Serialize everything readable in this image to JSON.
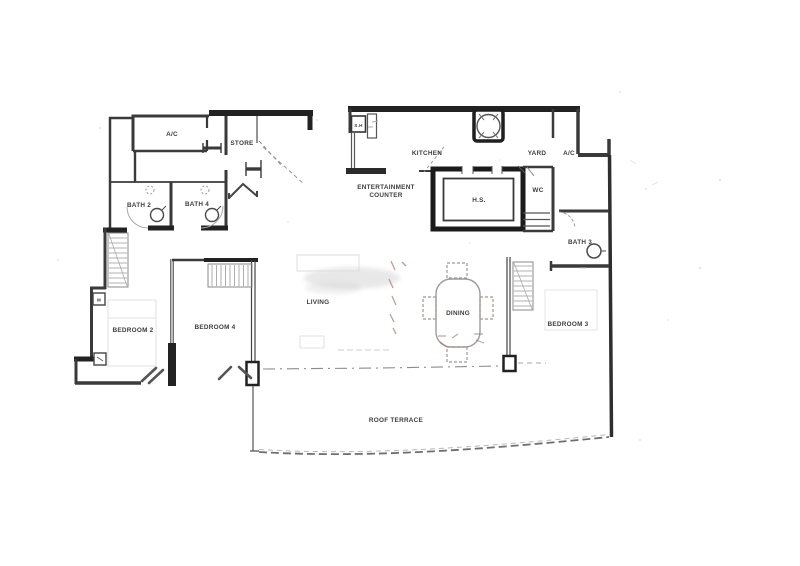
{
  "title": "apartment-floor-plan",
  "colors": {
    "background": "#ffffff",
    "wall_dark": "#222222",
    "wall_mid": "#3a3a3a",
    "wall_light": "#888888",
    "label_text": "#3d3d3d",
    "terrace_dash": "#6f6f6f",
    "furniture_red_accent": "#a5685c",
    "watermark_grey": "#c8c8c8"
  },
  "labels": {
    "ac_left": "A/C",
    "store": "STORE",
    "sh": "S.H",
    "kitchen": "KITCHEN",
    "yard": "YARD",
    "ac_right": "A/C",
    "entertainment_line1": "ENTERTAINMENT",
    "entertainment_line2": "COUNTER",
    "hs": "H.S.",
    "wc": "WC",
    "bath2": "BATH 2",
    "bath4": "BATH 4",
    "bath3": "BATH 3",
    "bedroom2": "BEDROOM 2",
    "bedroom4": "BEDROOM 4",
    "bedroom3": "BEDROOM 3",
    "living": "LIVING",
    "dining": "DINING",
    "roof_terrace": "ROOF TERRACE",
    "meter_box": "M"
  }
}
